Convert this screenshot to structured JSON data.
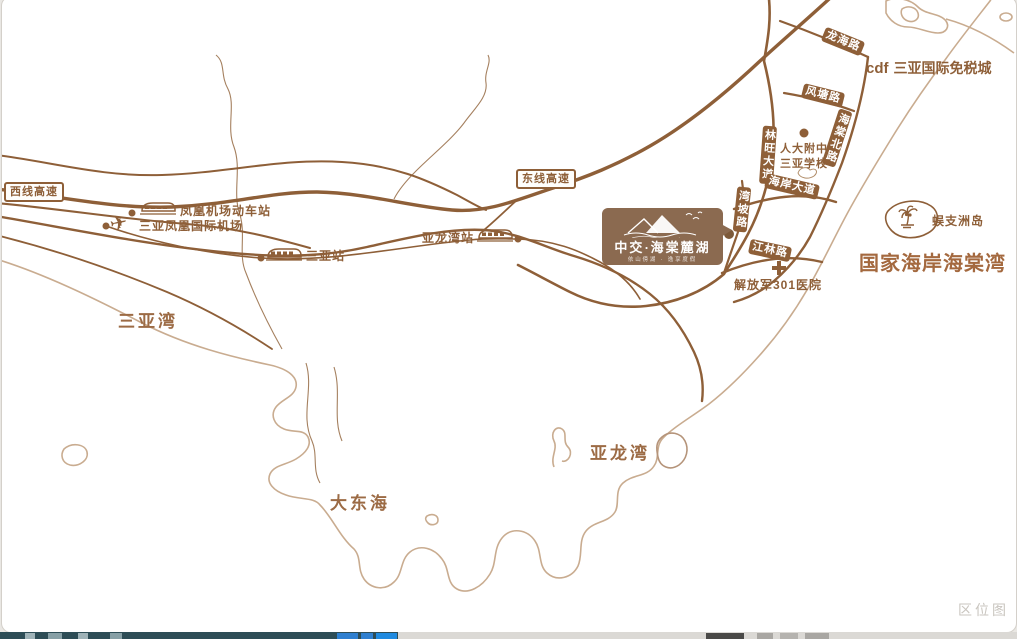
{
  "meta": {
    "watermark": "区位图"
  },
  "expressways": [
    {
      "label": "西线高速"
    },
    {
      "label": "东线高速"
    }
  ],
  "stations": {
    "airport_rail": "凤凰机场动车站",
    "airport": "三亚凤凰国际机场",
    "sanya": "三亚站",
    "yalong": "亚龙湾站"
  },
  "bays": {
    "sanya_bay": "三亚湾",
    "dadonghai": "大东海",
    "yalong_bay": "亚龙湾"
  },
  "roads": {
    "longhai": "龙海路",
    "fengtang": "风塘路",
    "haitang_north": "海棠北路",
    "linwang": "林旺大道",
    "haian": "海岸大道",
    "wanpo": "湾坡路",
    "jianglin": "江林路"
  },
  "pois": {
    "duty_free_prefix": "cdf",
    "duty_free": "三亚国际免税城",
    "school_line1": "人大附中",
    "school_line2": "三亚学校",
    "hospital": "解放军301医院",
    "island": "蜈支洲岛",
    "national_coast": "国家海岸海棠湾"
  },
  "project": {
    "name": "中交·海棠麓湖",
    "tagline": "依山傍湖 · 逸享度假"
  },
  "colors": {
    "road": "#8e5f38",
    "coast": "#c9ac90",
    "accent_bold": "#a4693f",
    "logo_bg": "#8b6a50"
  }
}
